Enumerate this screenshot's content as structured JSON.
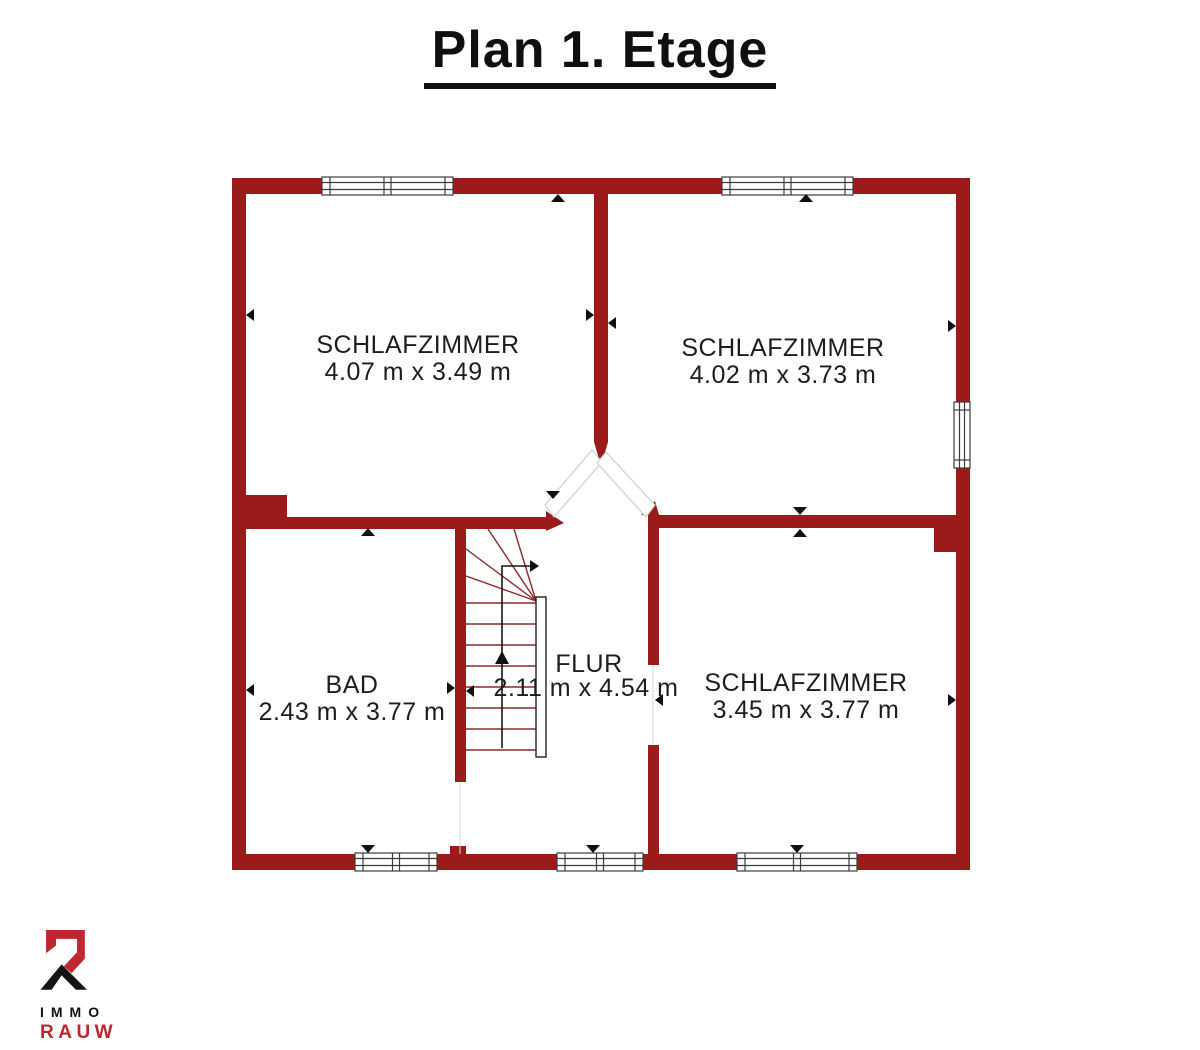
{
  "title": "Plan 1. Etage",
  "rooms": {
    "bedroom_top_left": {
      "name": "SCHLAFZIMMER",
      "dims": "4.07 m x 3.49 m"
    },
    "bedroom_top_right": {
      "name": "SCHLAFZIMMER",
      "dims": "4.02 m x 3.73 m"
    },
    "bath": {
      "name": "BAD",
      "dims": "2.43 m x 3.77 m"
    },
    "hall": {
      "name": "FLUR",
      "dims": "2.11 m x 4.54 m"
    },
    "bedroom_bottom_right": {
      "name": "SCHLAFZIMMER",
      "dims": "3.45 m x 3.77 m"
    }
  },
  "logo": {
    "brand_top": "IMMO",
    "brand_bottom": "RAUW"
  },
  "colors": {
    "wall": "#9b1b1b",
    "stair_line": "#8b2a2a",
    "text": "#1d1d1d",
    "logo_red": "#bf2630"
  }
}
